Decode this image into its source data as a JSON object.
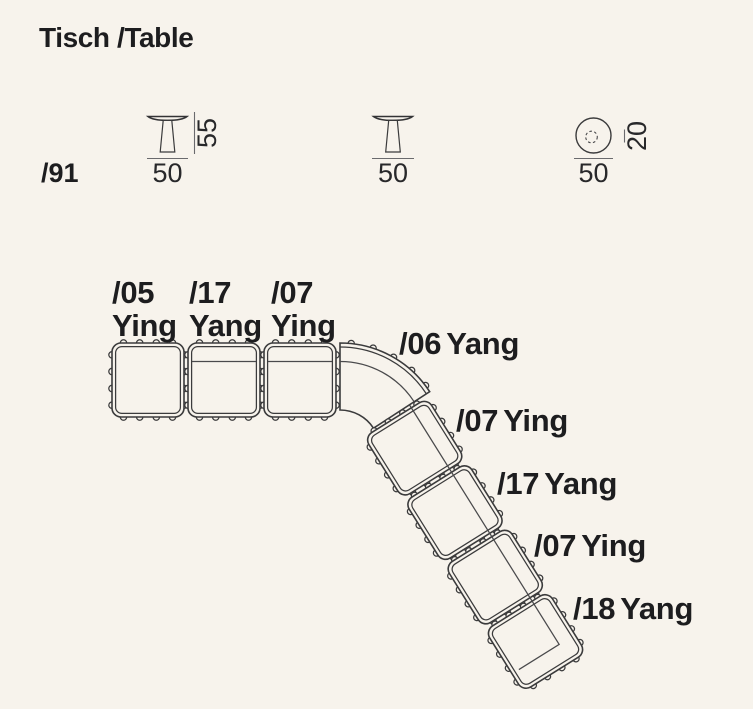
{
  "page": {
    "background_color": "#f7f3ec",
    "line_color": "#3b3b3c",
    "text_color": "#1d1d1f"
  },
  "header": {
    "title": "Tisch /Table",
    "series_code": "/91"
  },
  "tables": {
    "side_view_a": {
      "width_label": "50",
      "height_label": "55"
    },
    "side_view_b": {
      "width_label": "50"
    },
    "top_view": {
      "diameter_label": "50",
      "base_label": "20"
    }
  },
  "sofa": {
    "modules": [
      {
        "code": "/05",
        "name": "Ying",
        "slot": "row-0",
        "backrest": false,
        "end_return": false
      },
      {
        "code": "/17",
        "name": "Yang",
        "slot": "row-1",
        "backrest": true,
        "end_return": false
      },
      {
        "code": "/07",
        "name": "Ying",
        "slot": "row-2",
        "backrest": true,
        "end_return": false
      },
      {
        "code": "/06",
        "name": "Yang",
        "slot": "corner",
        "backrest": true,
        "end_return": false
      },
      {
        "code": "/07",
        "name": "Ying",
        "slot": "diag-0",
        "backrest": true,
        "end_return": false
      },
      {
        "code": "/17",
        "name": "Yang",
        "slot": "diag-1",
        "backrest": true,
        "end_return": false
      },
      {
        "code": "/07",
        "name": "Ying",
        "slot": "diag-2",
        "backrest": true,
        "end_return": false
      },
      {
        "code": "/18",
        "name": "Yang",
        "slot": "diag-3",
        "backrest": true,
        "end_return": true
      }
    ]
  }
}
